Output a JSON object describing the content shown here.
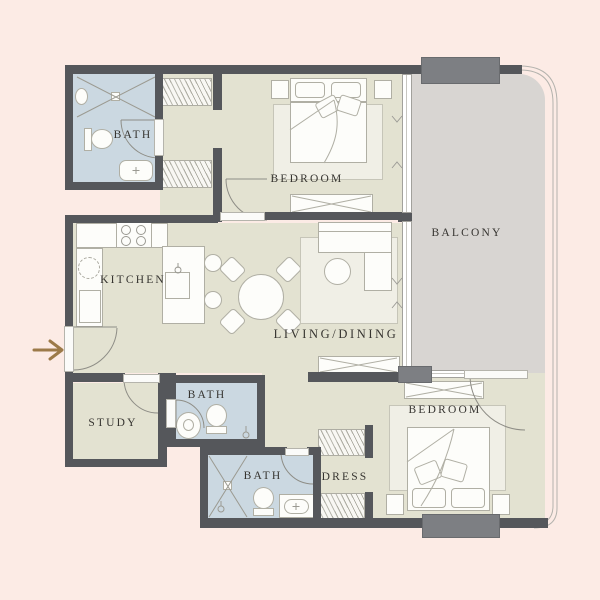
{
  "palette": {
    "bg": "#fcebe5",
    "floor": "#e3e2d1",
    "bathFloor": "#cbd8e1",
    "balconyFloor": "#d8d5d2",
    "wall": "#55575b",
    "pillar": "#7d7f83",
    "furnLine": "#b0afa4",
    "furnFill": "#fdfdfa",
    "lineArt": "#8e8d86",
    "label": "#363430",
    "arrow": "#9c7a49"
  },
  "labels": {
    "bath_top": "BATH",
    "bedroom_top": "BEDROOM",
    "balcony": "BALCONY",
    "kitchen": "KITCHEN",
    "living_dining": "LIVING/DINING",
    "study": "STUDY",
    "bath_middle": "BATH",
    "bath_bottom": "BATH",
    "dress": "DRESS",
    "bedroom_bottom": "BEDROOM"
  },
  "icons": {
    "entry_arrow": "entry-arrow pointing right at unit entrance"
  }
}
